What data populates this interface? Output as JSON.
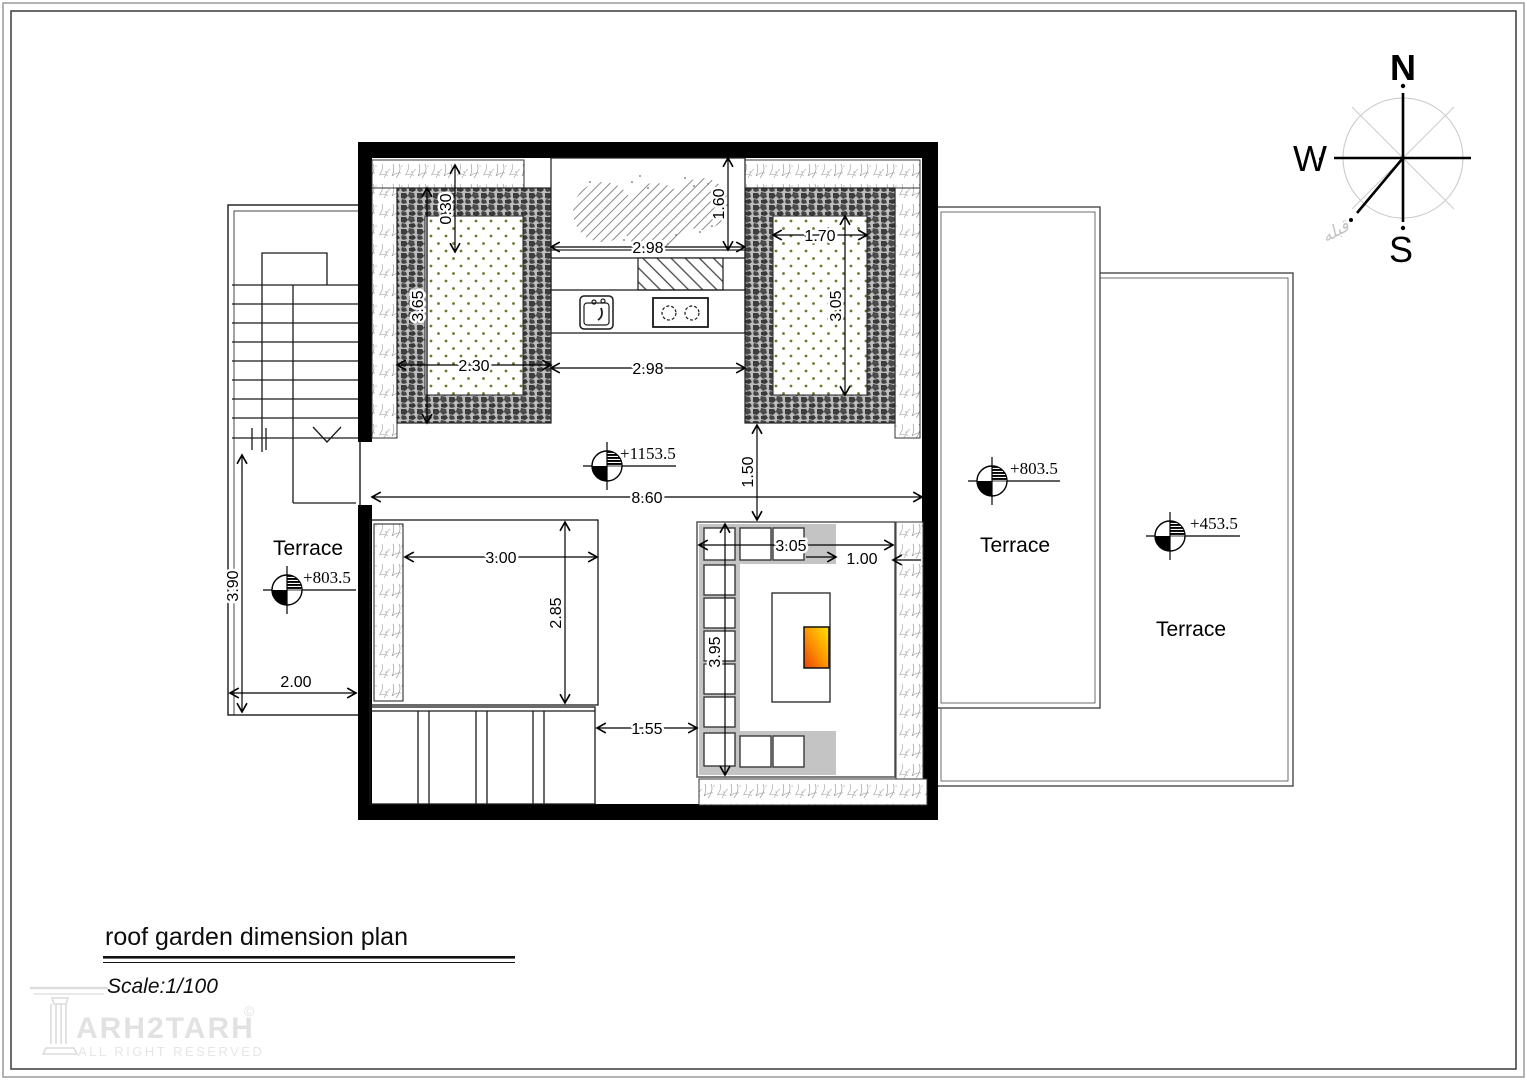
{
  "page": {
    "title": "roof garden dimension plan",
    "scale": "Scale:1/100"
  },
  "logo": {
    "brand": "ARH2TARH",
    "copyright": "©",
    "tagline": "ALL RIGHT RESERVED"
  },
  "compass": {
    "north": "N",
    "west": "W",
    "south": "S",
    "qibla_label": "قبله"
  },
  "levels": {
    "roof": "+1153.5",
    "terrace_left": "+803.5",
    "terrace_right_upper": "+803.5",
    "terrace_right_lower": "+453.5"
  },
  "rooms": {
    "terrace_left": "Terrace",
    "terrace_right_upper": "Terrace",
    "terrace_right_lower": "Terrace"
  },
  "dimensions": {
    "gravel_border_width": "0.30",
    "left_bed_height": "3.65",
    "left_bed_width": "2.30",
    "tree_planter_width": "2.98",
    "tree_planter_depth": "1.60",
    "right_bed_width": "1.70",
    "right_bed_height": "3.05",
    "kitchen_width": "2.98",
    "roof_width": "8.60",
    "bed_to_sofa_gap": "1.50",
    "room_width": "3.00",
    "room_depth": "2.85",
    "sofa_width": "3.05",
    "sofa_right_offset": "1.00",
    "sofa_depth": "3.95",
    "deck_gap": "1.55",
    "terrace_left_height": "3.90",
    "terrace_left_width": "2.00"
  },
  "colors": {
    "fire_hot": "#e8420a",
    "fire_mid": "#ff9800",
    "fire_cool": "#ffe200",
    "line": "#1a1a1a"
  }
}
